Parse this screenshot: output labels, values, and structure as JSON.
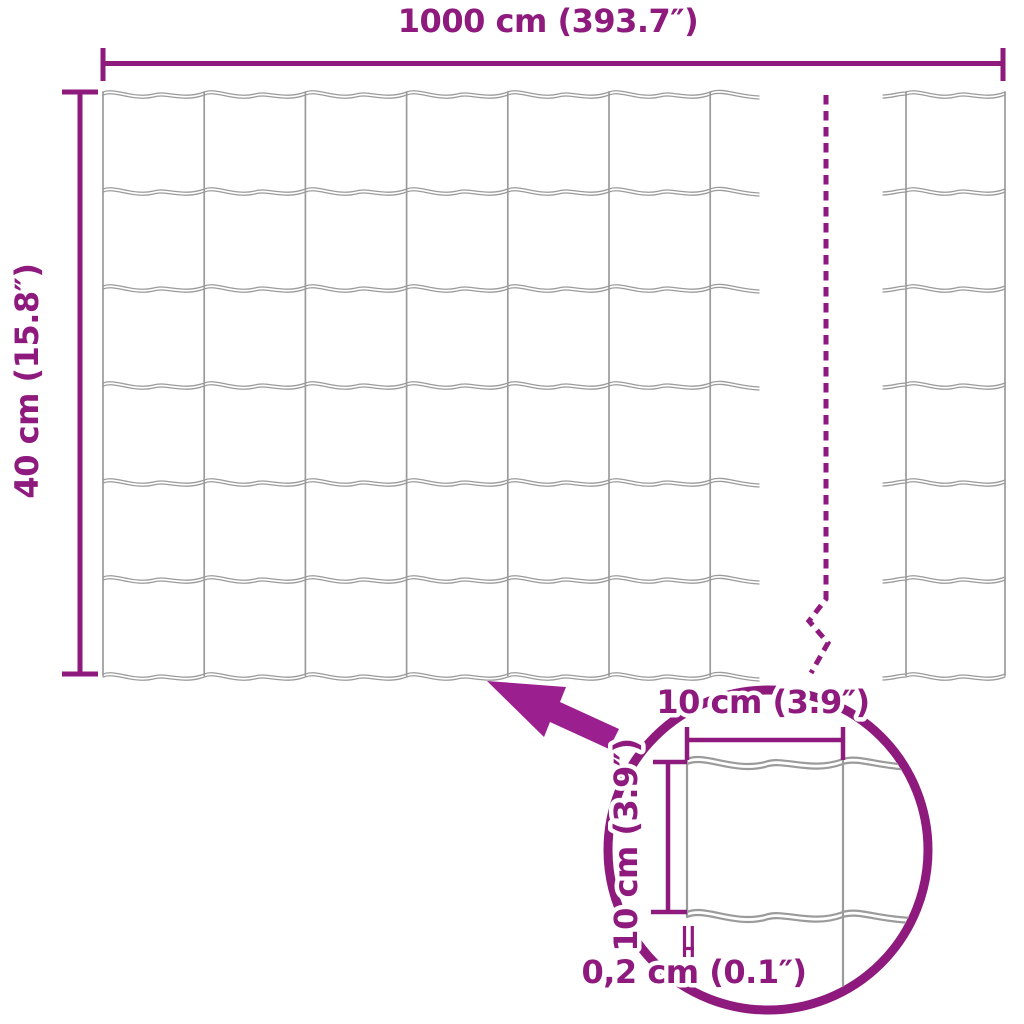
{
  "colors": {
    "accent": "#8E1A7E",
    "arrow_fill": "#9C1F90",
    "wire_gray": "#9B9B9B",
    "background": "#FFFFFF"
  },
  "labels": {
    "overall_width": "1000 cm (393.7″)",
    "overall_height": "40 cm (15.8″)",
    "detail_cell_width": "10 cm (3.9″)",
    "detail_cell_height": "10 cm (3.9″)",
    "detail_wire_thickness": "0,2 cm (0.1″)"
  },
  "mesh": {
    "visible_rows": 6,
    "visible_full_columns": 6,
    "has_break_indicator": true,
    "detail_magnifier_shown": true
  }
}
